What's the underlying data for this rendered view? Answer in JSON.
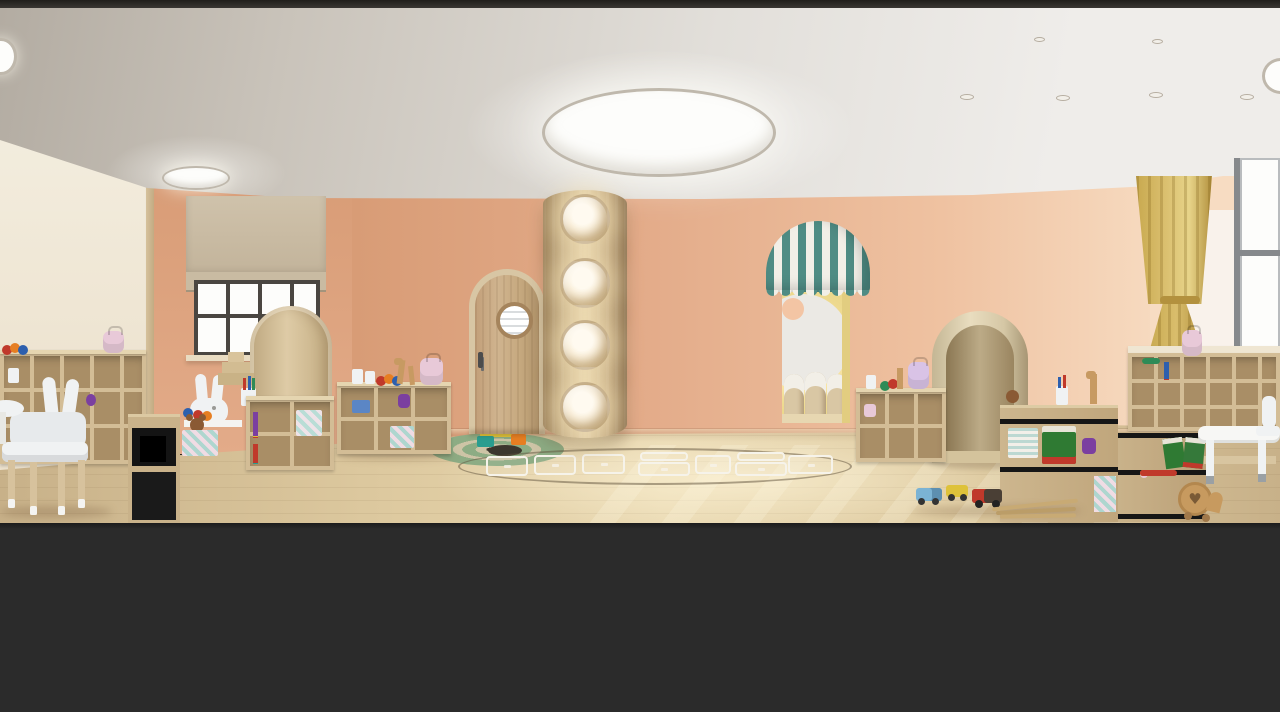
{
  "meta": {
    "scene": "kindergarten-playroom-interior-render",
    "visible_text": "none",
    "letterboxed": true
  },
  "palette": {
    "ink": "#26241f",
    "ceil1": "#c9c3ba",
    "ceil2": "#e2dfda",
    "ceil3": "#efedea",
    "cream": "#f3edde",
    "trim": "#d6c19c",
    "peach1": "#d89c76",
    "peach2": "#e3ab89",
    "peach3": "#efc2a1",
    "peach4": "#f7dcc2",
    "floor1": "#c8b189",
    "floor2": "#ddc99f",
    "floor3": "#e9d8b1",
    "edge": "#e9e0ca",
    "woodFrame": "#d3bd96",
    "woodIn": "#a98e66",
    "woodTop": "#e5d5b0",
    "archLight": "#decba6",
    "archPale": "#e9ddbf",
    "doorFrame": "#d8c6a4",
    "white": "#f0f2f3",
    "offwhite": "#fdfdfb",
    "glass": "#fdfdfb",
    "frameDark": "#4a4641",
    "frameGray": "#86898c",
    "teal": "#4f8c84",
    "awnWhite": "#f2efe7",
    "innerYellow": "#ecd88c",
    "innerWall": "#ebe9e4",
    "peachCircle": "#f3c5a4",
    "curtain": "#d9bd6c",
    "curtainDark": "#b3913e",
    "sheer": "rgba(250,249,246,0.78)",
    "rug1": "#8dac84",
    "rug2": "#cdc4a6",
    "rugHole": "#3c372e",
    "lineWhite": "#f6f3ea",
    "glow1": "#f7ead0",
    "glow2": "#e9d4a9",
    "glowRim": "#bfb8ac",
    "toyRed": "#c0392b",
    "toyOrange": "#e67e22",
    "toyYellow": "#dec23a",
    "toyGreen": "#2e8b57",
    "toyBlue": "#2d5fae",
    "toyPurple": "#7b3fa0",
    "toyTeal": "#2a9d8f",
    "toyPink": "#e8c9d8",
    "toyLilac": "#d9c3e6",
    "woodToy": "#c79a5f",
    "bookGreen": "#2f7a33"
  },
  "inventory": {
    "ceiling_lights": {
      "large_round": 1,
      "medium_round": 1,
      "corner_partial": 1,
      "recessed_spots": 6
    },
    "column_porthole_lights": 4,
    "hopscotch_cells": 9,
    "awning_doorway": 1,
    "arched_wood_door": 1,
    "wood_arches": 2,
    "windows": {
      "left_with_roman_shade": 1,
      "right_with_yellow_curtain": 1
    },
    "bunny_ear_chairs": 2,
    "cubby_shelf_units": 7,
    "backpacks": 4,
    "toy_vehicles": 4,
    "rainbow_stackers": 2
  }
}
